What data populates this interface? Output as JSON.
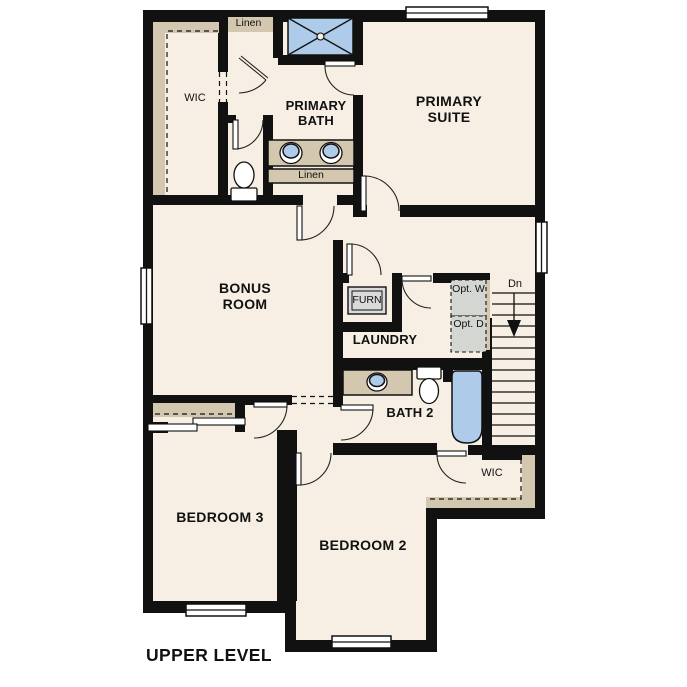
{
  "plan": {
    "title": "UPPER LEVEL",
    "rooms": {
      "primary_suite": "PRIMARY SUITE",
      "primary_bath": "PRIMARY BATH",
      "wic_primary": "WIC",
      "bonus_room": "BONUS ROOM",
      "laundry": "LAUNDRY",
      "bath_2": "BATH 2",
      "bedroom_2": "BEDROOM 2",
      "bedroom_3": "BEDROOM 3",
      "wic_bedroom2": "WIC"
    },
    "labels": {
      "linen_upper": "Linen",
      "linen_lower": "Linen",
      "furnace": "FURN",
      "opt_washer": "Opt. W",
      "opt_dryer": "Opt. D",
      "stairs_down": "Dn"
    },
    "fixtures": [
      "shower",
      "double-vanity-sinks",
      "toilet-primary",
      "toilet-bath2",
      "vanity-sink-bath2",
      "bathtub",
      "furnace-unit",
      "optional-washer",
      "optional-dryer",
      "stairs-down",
      "bypass-closet-doors"
    ],
    "colors": {
      "floor": "#f7efe3",
      "wall": "#111111",
      "casework": "#d4c7af",
      "fixture_blue": "#aecbe9",
      "furn_grey": "#dadada",
      "wd_grey": "#d3d6d1",
      "outside": "#ffffff"
    }
  }
}
